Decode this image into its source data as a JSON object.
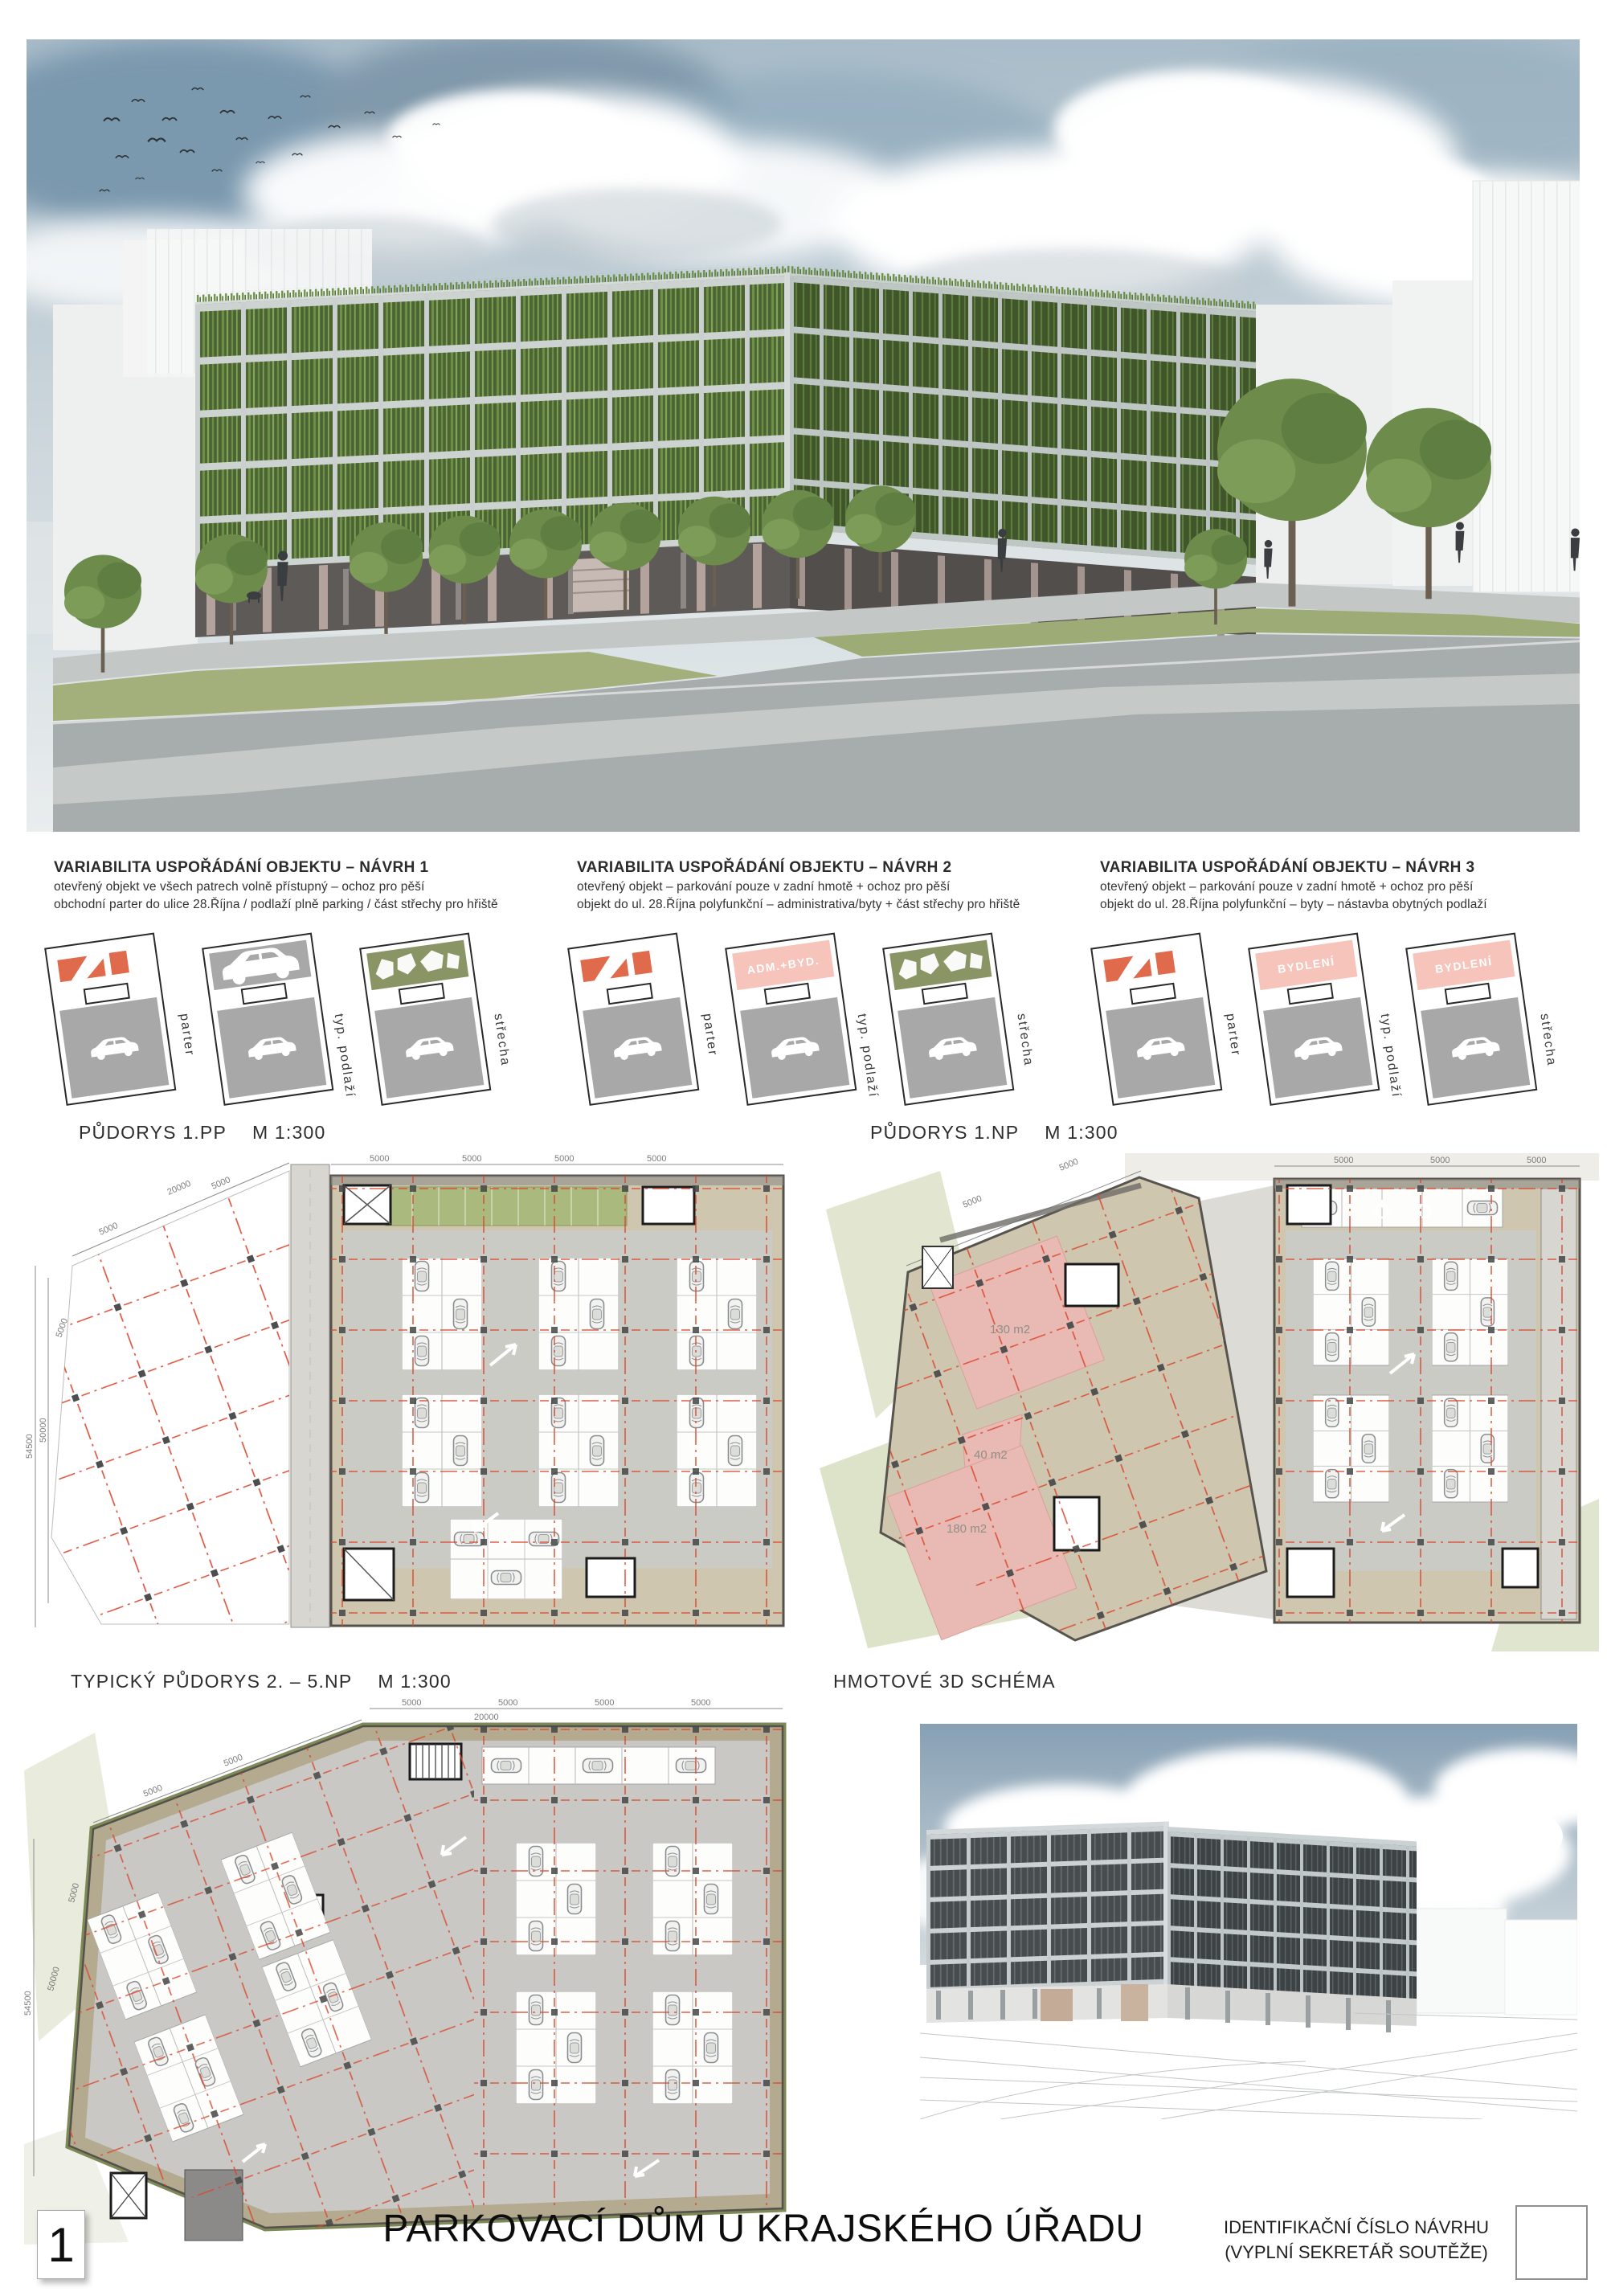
{
  "footer": {
    "sheet_number": "1",
    "title": "PARKOVACÍ DŮM U KRAJSKÉHO ÚŘADU",
    "id_line1": "IDENTIFIKAČNÍ ČÍSLO NÁVRHU",
    "id_line2": "(VYPLNÍ SEKRETÁŘ SOUTĚŽE)"
  },
  "variants": [
    {
      "heading": "VARIABILITA USPOŘÁDÁNÍ OBJEKTU – NÁVRH 1",
      "line1": "otevřený objekt ve všech patrech volně přístupný – ochoz pro pěší",
      "line2": "obchodní parter do ulice 28.Října / podlaží plně parking / část střechy pro hřiště",
      "diagrams": [
        {
          "label": "parter",
          "band": "commerce"
        },
        {
          "label": "typ. podlaží",
          "band": "parking"
        },
        {
          "label": "střecha",
          "band": "playground"
        }
      ]
    },
    {
      "heading": "VARIABILITA USPOŘÁDÁNÍ OBJEKTU – NÁVRH 2",
      "line1": "otevřený objekt – parkování pouze v zadní hmotě + ochoz pro pěší",
      "line2": "objekt do ul. 28.Října polyfunkční – administrativa/byty + část střechy pro hřiště",
      "diagrams": [
        {
          "label": "parter",
          "band": "commerce"
        },
        {
          "label": "typ. podlaží",
          "band": "residential",
          "band_label": "ADM.+BYD."
        },
        {
          "label": "střecha",
          "band": "playground"
        }
      ]
    },
    {
      "heading": "VARIABILITA USPOŘÁDÁNÍ OBJEKTU – NÁVRH 3",
      "line1": "otevřený objekt – parkování pouze v zadní hmotě + ochoz pro pěší",
      "line2": "objekt do ul. 28.Října polyfunkční – byty – nástavba obytných podlaží",
      "diagrams": [
        {
          "label": "parter",
          "band": "commerce"
        },
        {
          "label": "typ. podlaží",
          "band": "residential",
          "band_label": "BYDLENÍ"
        },
        {
          "label": "střecha",
          "band": "residential",
          "band_label": "BYDLENÍ"
        }
      ]
    }
  ],
  "plans": {
    "pp": {
      "title": "PŮDORYS 1.PP",
      "scale": "M 1:300"
    },
    "np": {
      "title": "PŮDORYS 1.NP",
      "scale": "M 1:300",
      "areas": {
        "a1": "130 m2",
        "a2": "40 m2",
        "a3": "180 m2"
      }
    },
    "typical": {
      "title": "TYPICKÝ PŮDORYS 2. – 5.NP",
      "scale": "M 1:300"
    },
    "schema_title": "HMOTOVÉ 3D SCHÉMA",
    "dims": {
      "d5000": "5000",
      "d20000": "20000",
      "d50000": "50000",
      "d54500": "54500",
      "d4500": "4500"
    }
  },
  "colors": {
    "accent_orange": "#df6a4c",
    "accent_pink": "#f6c4ba",
    "roof_green": "#8a9566",
    "facade_green": "#6f9247",
    "grid_red": "#d9452c",
    "plan_beige": "#cfc6b0"
  }
}
